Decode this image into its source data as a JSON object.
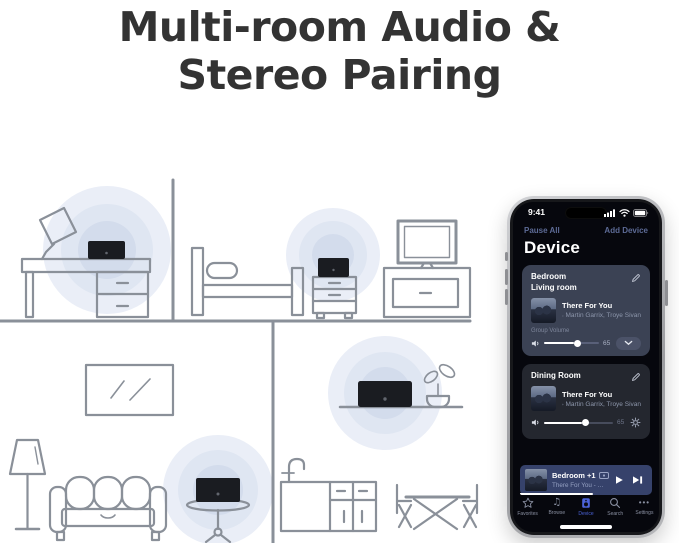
{
  "title": {
    "line1": "Multi-room Audio &",
    "line2": "Stereo Pairing"
  },
  "colors": {
    "accent_blue": "#4c64da",
    "link_blue": "#5d6b96",
    "halo_blue": "#dfe6f2",
    "line_gray": "#8a9099",
    "speaker_black": "#1a1c21",
    "card_bedroom": "#3b4254",
    "card_dining": "#24272f",
    "mini_player_bg": "#36426b"
  },
  "phone": {
    "status_bar": {
      "time": "9:41"
    },
    "header": {
      "pause_all": "Pause All",
      "add_device": "Add Device",
      "title": "Device"
    },
    "cards": [
      {
        "room_line1": "Bedroom",
        "room_line2": "Living room",
        "track": "There For You",
        "artist": "Martin Garrix, Troye Sivan",
        "group_volume_label": "Group Volume",
        "volume": "65"
      },
      {
        "room_line1": "Dining Room",
        "track": "There For You",
        "artist": "Martin Garrix, Troye Sivan",
        "volume": "65"
      }
    ],
    "mini_player": {
      "title": "Bedroom +1",
      "subtitle": "There For You - Martin Garrix"
    },
    "tab_bar": {
      "active": "Device",
      "items": [
        {
          "label": "Favorites"
        },
        {
          "label": "Browse",
          "glyph": "♫"
        },
        {
          "label": "Device"
        },
        {
          "label": "Search"
        },
        {
          "label": "Settings",
          "glyph": "•••"
        }
      ]
    }
  }
}
